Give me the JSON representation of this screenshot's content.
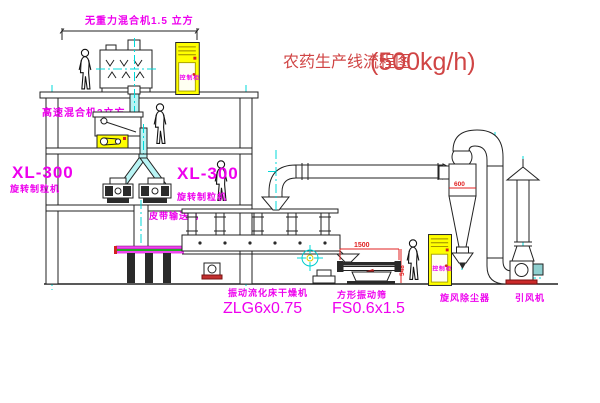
{
  "title": {
    "name": "农药生产线流程图",
    "capacity": "(500kg/h)"
  },
  "equipment_labels": {
    "gravity_mixer": "无重力混合机1.5 立方",
    "high_speed_mixer": "高速混合机3立方",
    "granulator_left_model": "XL-300",
    "granulator_left_name": "旋转制粒机",
    "granulator_mid_model": "XL-300",
    "granulator_mid_name": "旋转制粒机",
    "belt_conveyor": "皮带输送机",
    "fluid_bed_dryer_name": "振动流化床干燥机",
    "fluid_bed_dryer_model": "ZLG6x0.75",
    "square_sieve_name": "方形振动筛",
    "square_sieve_model": "FS0.6x1.5",
    "cyclone": "旋风除尘器",
    "fan": "引风机",
    "control_cabinet": "控制柜"
  },
  "dimensions": {
    "sieve_length": "1500",
    "sieve_height": "548",
    "cyclone_diameter": "600"
  },
  "colors": {
    "label_magenta": "#ee00ee",
    "title_red": "#d04545",
    "dimension_red": "#e02020",
    "centerline_cyan": "#00d8d8",
    "cabinet_yellow": "#ffff00",
    "line_black": "#222222"
  }
}
